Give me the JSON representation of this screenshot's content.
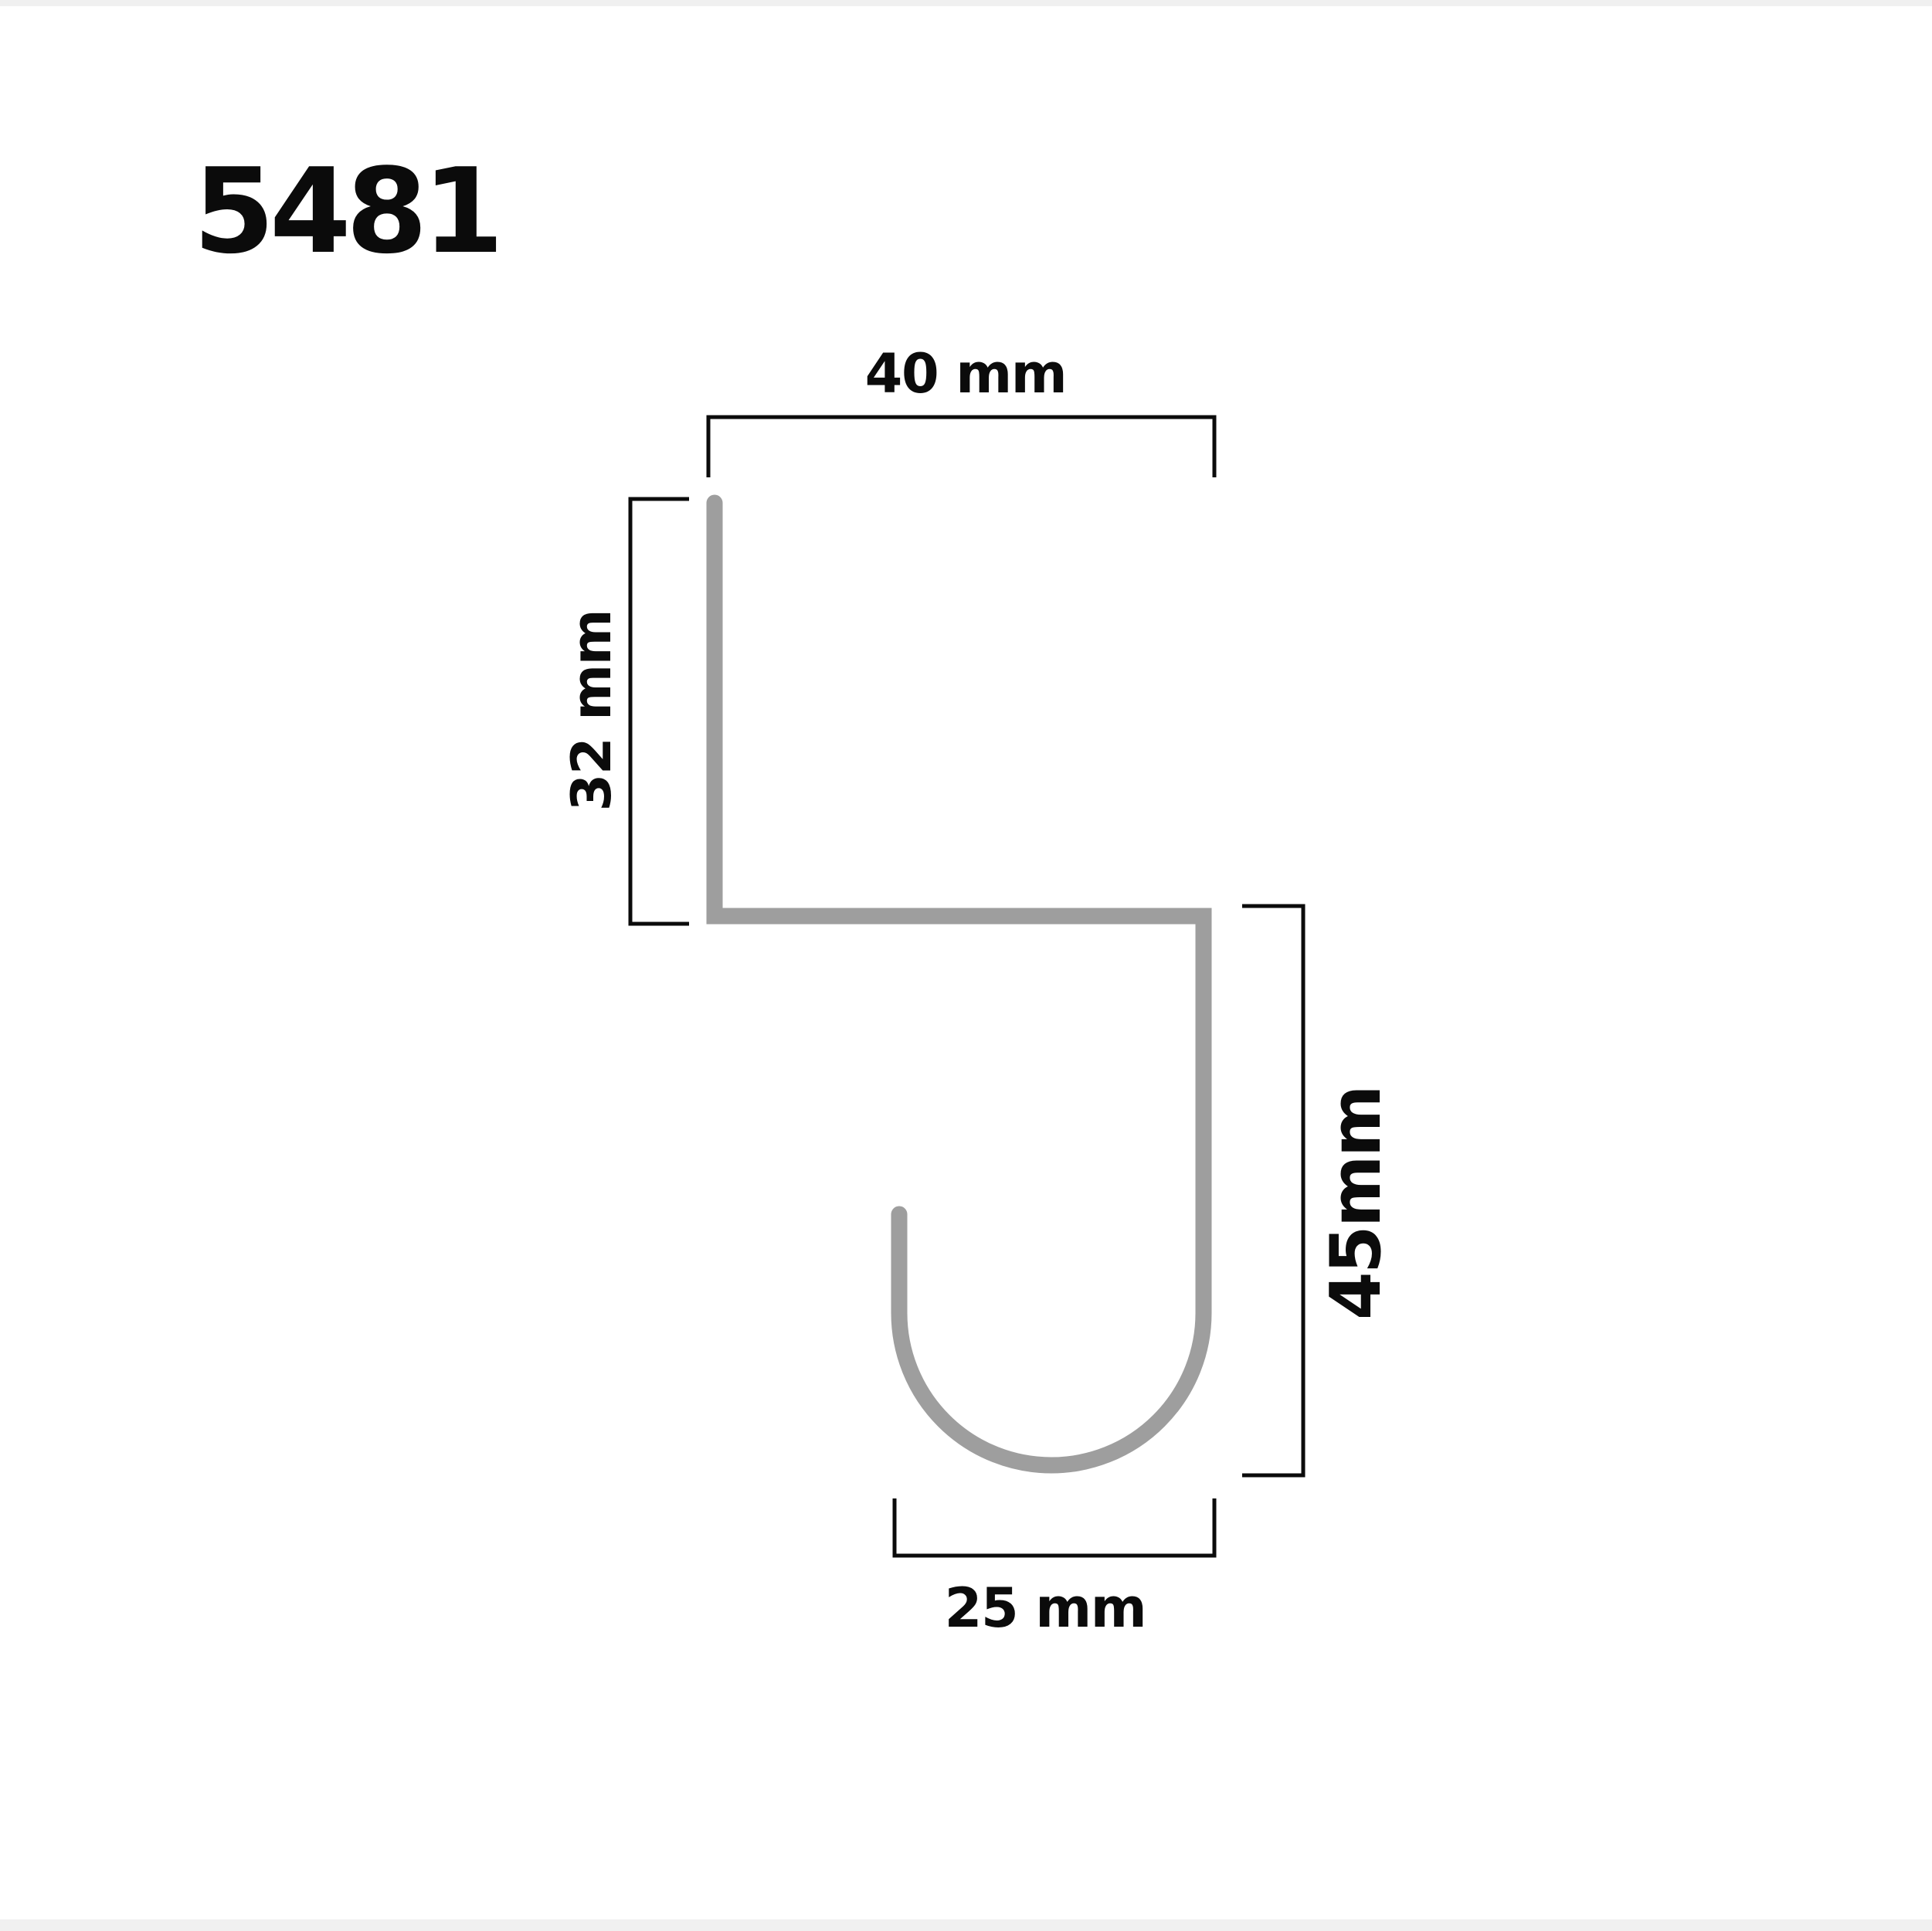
{
  "page": {
    "title": "5481",
    "background": "#ffffff",
    "edge_strip_color": "#f0f0f0",
    "ink_color": "#0b0b0b"
  },
  "diagram": {
    "type": "technical-dimension-diagram",
    "shape": "s-hook-profile",
    "profile_stroke_color": "#9e9e9e",
    "dimension_line_color": "#0b0b0b",
    "dimensions": {
      "top_width": {
        "label": "40 mm",
        "value_mm": 40,
        "orientation": "horizontal"
      },
      "left_height": {
        "label": "32 mm",
        "value_mm": 32,
        "orientation": "vertical"
      },
      "right_height": {
        "label": "45mm",
        "value_mm": 45,
        "orientation": "vertical"
      },
      "bottom_width": {
        "label": "25 mm",
        "value_mm": 25,
        "orientation": "horizontal"
      }
    }
  }
}
